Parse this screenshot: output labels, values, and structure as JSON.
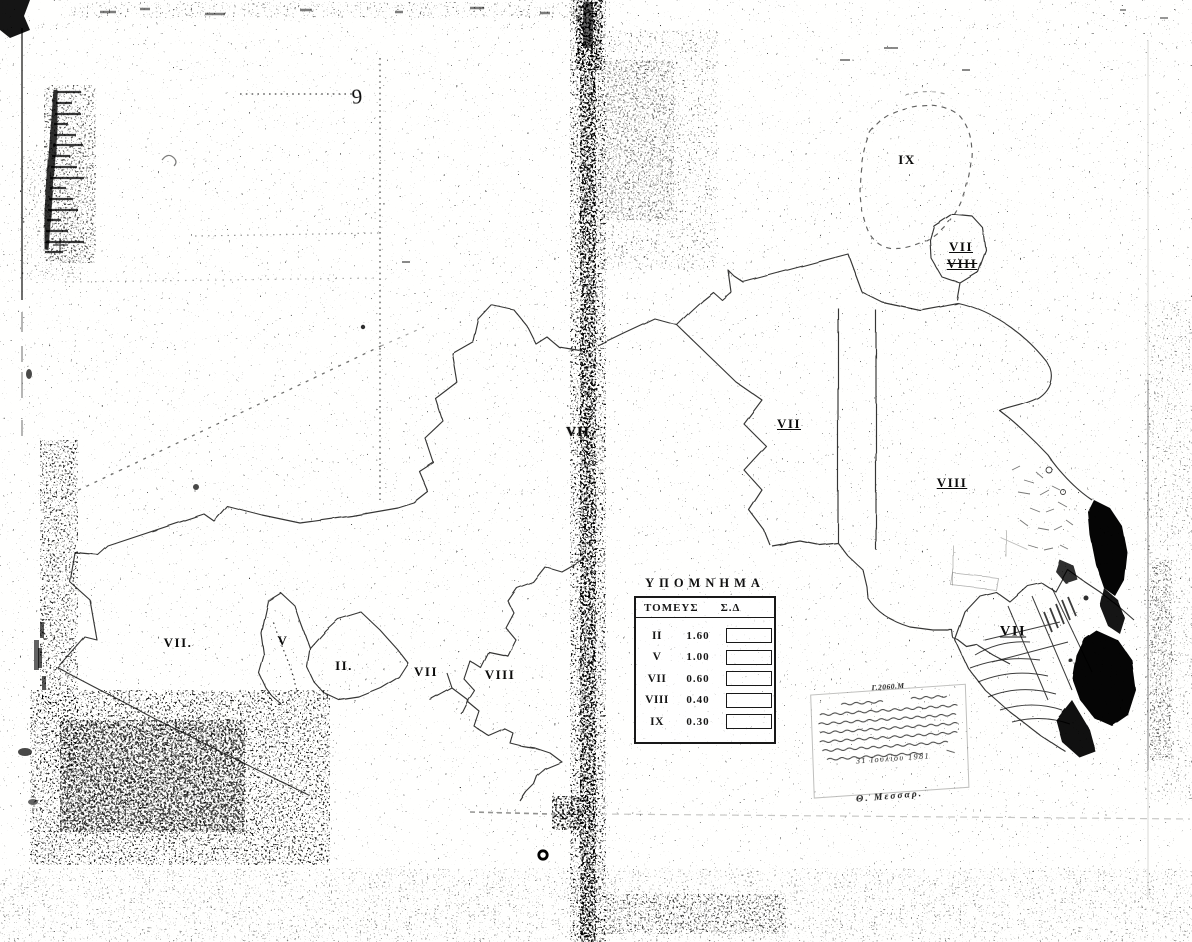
{
  "colors": {
    "paper": "#fbfbf9",
    "ink": "#1a1a1a"
  },
  "map": {
    "sheet_number": "9",
    "zone_labels": [
      {
        "text": "VII."
      },
      {
        "text": "V"
      },
      {
        "text": "II."
      },
      {
        "text": "VII"
      },
      {
        "text": "VIII"
      },
      {
        "text": "VII"
      },
      {
        "text": "VII"
      },
      {
        "text": "VIII"
      },
      {
        "text": "IX"
      },
      {
        "text": "VII"
      },
      {
        "text": "VIII"
      },
      {
        "text": "VII"
      }
    ]
  },
  "legend": {
    "title": "ΥΠΟΜΝΗΜΑ",
    "columns": [
      "ΤΟΜΕΥΣ",
      "Σ.Δ"
    ],
    "rows": [
      {
        "sector": "II",
        "value": "1.60"
      },
      {
        "sector": "V",
        "value": "1.00"
      },
      {
        "sector": "VII",
        "value": "0.60"
      },
      {
        "sector": "VIII",
        "value": "0.40"
      },
      {
        "sector": "IX",
        "value": "0.30"
      }
    ]
  },
  "stamp": {
    "reference": "Γ.2060.Μ",
    "date": "31 Ιουλίου 1981",
    "signature": "Θ. Μεσσαρ."
  }
}
